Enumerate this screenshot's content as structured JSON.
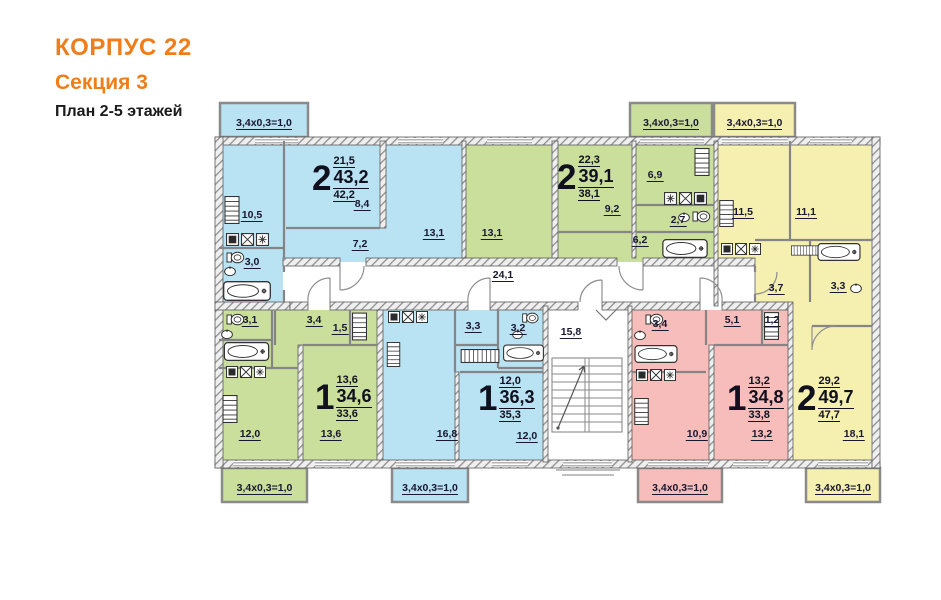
{
  "header": {
    "building": "КОРПУС 22",
    "section": "Секция 3",
    "plan": "План 2-5 этажей"
  },
  "balcony_label": "3,4x0,3=1,0",
  "common": {
    "corridor_area": "24,1",
    "stairwell_area": "15,8"
  },
  "apartments": [
    {
      "name": "2-room-top-left",
      "color_name": "blue",
      "rooms_count": "2",
      "living_area": "21,5",
      "total_area": "43,2",
      "area_no_balcony": "42,2",
      "rooms": {
        "kitchen": "10,5",
        "bathroom": "3,0",
        "hall": "7,2",
        "room_a": "8,4",
        "room_b": "13,1"
      }
    },
    {
      "name": "2-room-top-middle",
      "color_name": "green",
      "rooms_count": "2",
      "living_area": "22,3",
      "total_area": "39,1",
      "area_no_balcony": "38,1",
      "rooms": {
        "room_a": "13,1",
        "room_b": "9,2",
        "kitchen": "6,9",
        "bathroom": "2,7",
        "hall": "6,2"
      }
    },
    {
      "name": "2-room-right",
      "color_name": "yellow",
      "rooms_count": "2",
      "living_area": "29,2",
      "total_area": "49,7",
      "area_no_balcony": "47,7",
      "rooms": {
        "kitchen": "11,5",
        "room_a": "11,1",
        "hall": "3,7",
        "bathroom": "3,3",
        "room_b": "18,1"
      }
    },
    {
      "name": "1-room-bottom-left",
      "color_name": "green",
      "rooms_count": "1",
      "living_area": "13,6",
      "total_area": "34,6",
      "area_no_balcony": "33,6",
      "rooms": {
        "bathroom": "3,1",
        "hall": "3,4",
        "closet": "1,5",
        "kitchen": "12,0",
        "room_a": "13,6"
      }
    },
    {
      "name": "1-room-bottom-middle",
      "color_name": "blue",
      "rooms_count": "1",
      "living_area": "12,0",
      "total_area": "36,3",
      "area_no_balcony": "35,3",
      "rooms": {
        "hall": "3,3",
        "bathroom": "3,2",
        "kitchen": "16,8",
        "room_a": "12,0"
      }
    },
    {
      "name": "1-room-bottom-right",
      "color_name": "pink",
      "rooms_count": "1",
      "living_area": "13,2",
      "total_area": "34,8",
      "area_no_balcony": "33,8",
      "rooms": {
        "bathroom": "3,4",
        "hall": "5,1",
        "closet": "1,2",
        "kitchen": "10,9",
        "room_a": "13,2"
      }
    }
  ],
  "colors": {
    "blue": "#b9e2f3",
    "green": "#cbdf9d",
    "yellow": "#f5f0b0",
    "pink": "#f6bdba",
    "wall_hatch": "#8f8f8f",
    "label_text": "#181830",
    "accent_orange": "#ee7d1a"
  }
}
